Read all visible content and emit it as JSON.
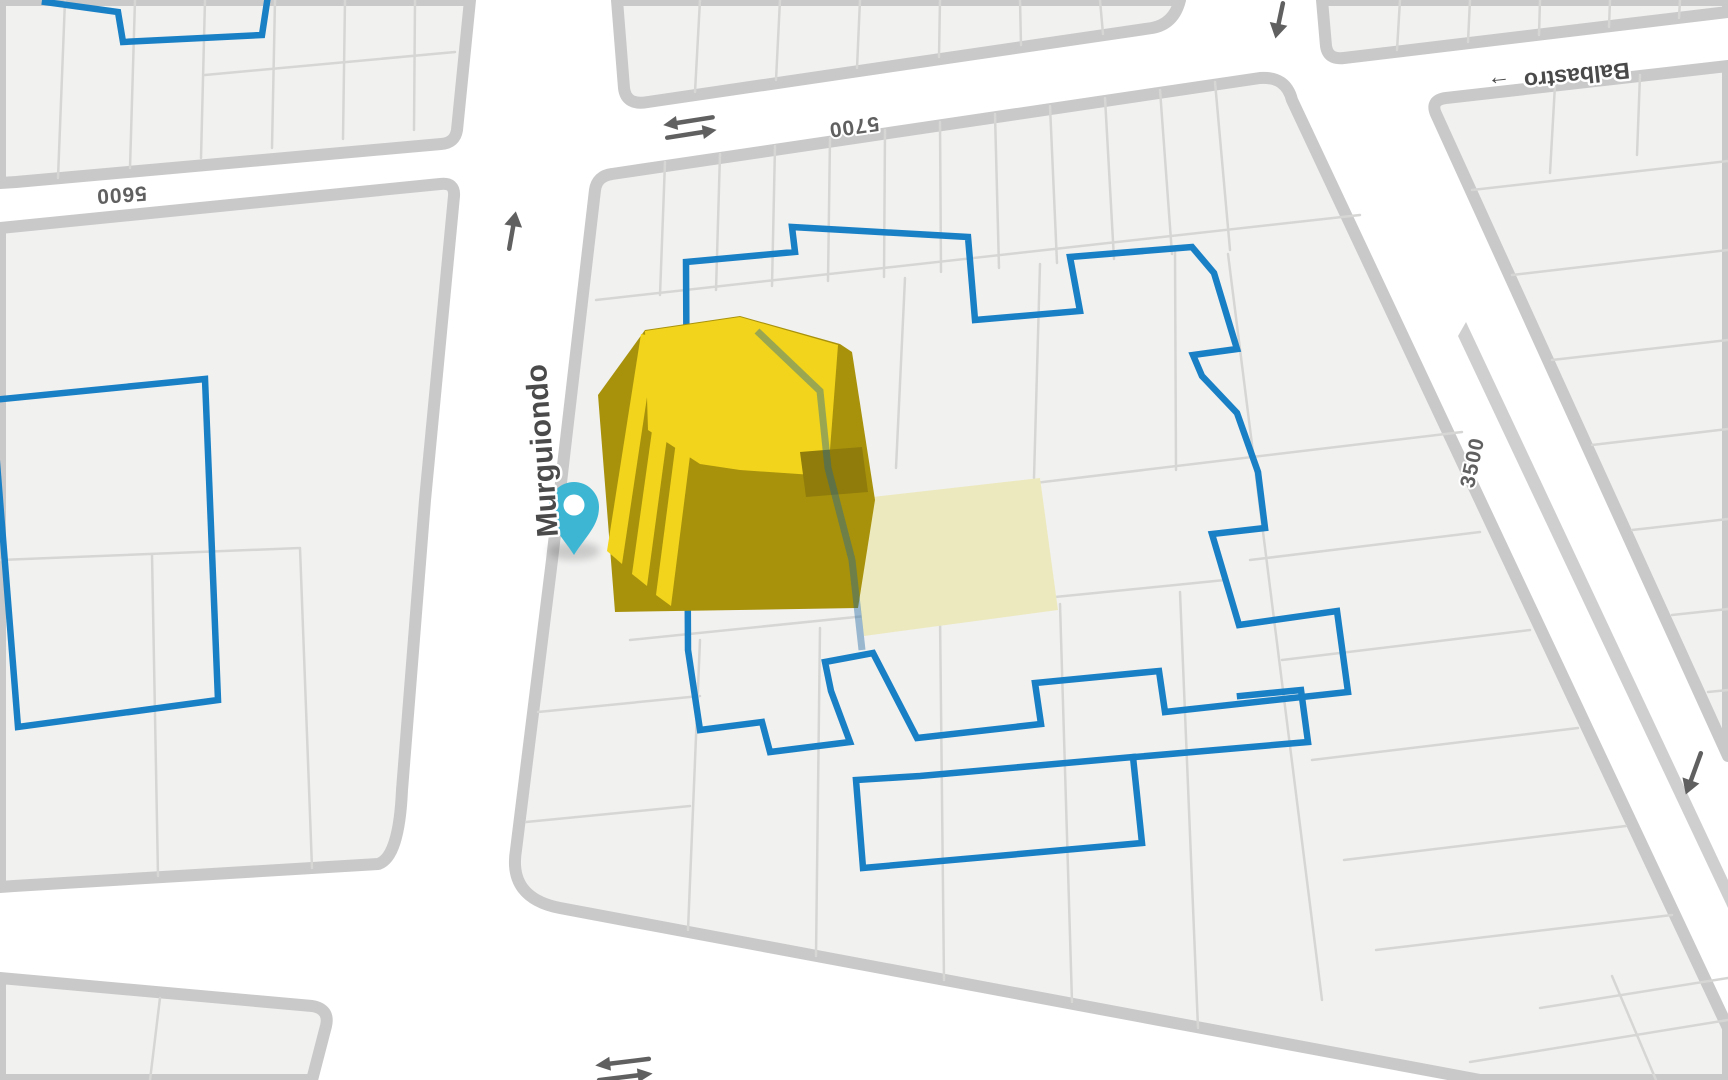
{
  "map": {
    "labels": {
      "street_murguiondo": "Murguiondo",
      "street_balbastro": "Balbastro",
      "balbastro_oneway_arrow": "→",
      "block_number_5600": "5600",
      "block_number_5700": "5700",
      "block_number_3500": "3500"
    },
    "icons": {
      "location-pin-icon": "pin",
      "oneway-up-arrow-icon": "↑",
      "oneway-down-arrow-icon": "↓",
      "two-way-arrow-icon": "⇄"
    },
    "colors": {
      "parcel_boundary_blue": "#1a80c5",
      "building_top_yellow": "#f2d41c",
      "building_side_olive": "#a8920c",
      "building_shade_olive": "#8f7c0a",
      "marker_teal": "#3db6d4",
      "highlight_parcel_cream": "#ece9bf",
      "block_fill": "#f1f1f0",
      "curb_gray": "#c9c9c9",
      "road_white": "#ffffff",
      "label_gray": "#4a4a4a"
    }
  }
}
